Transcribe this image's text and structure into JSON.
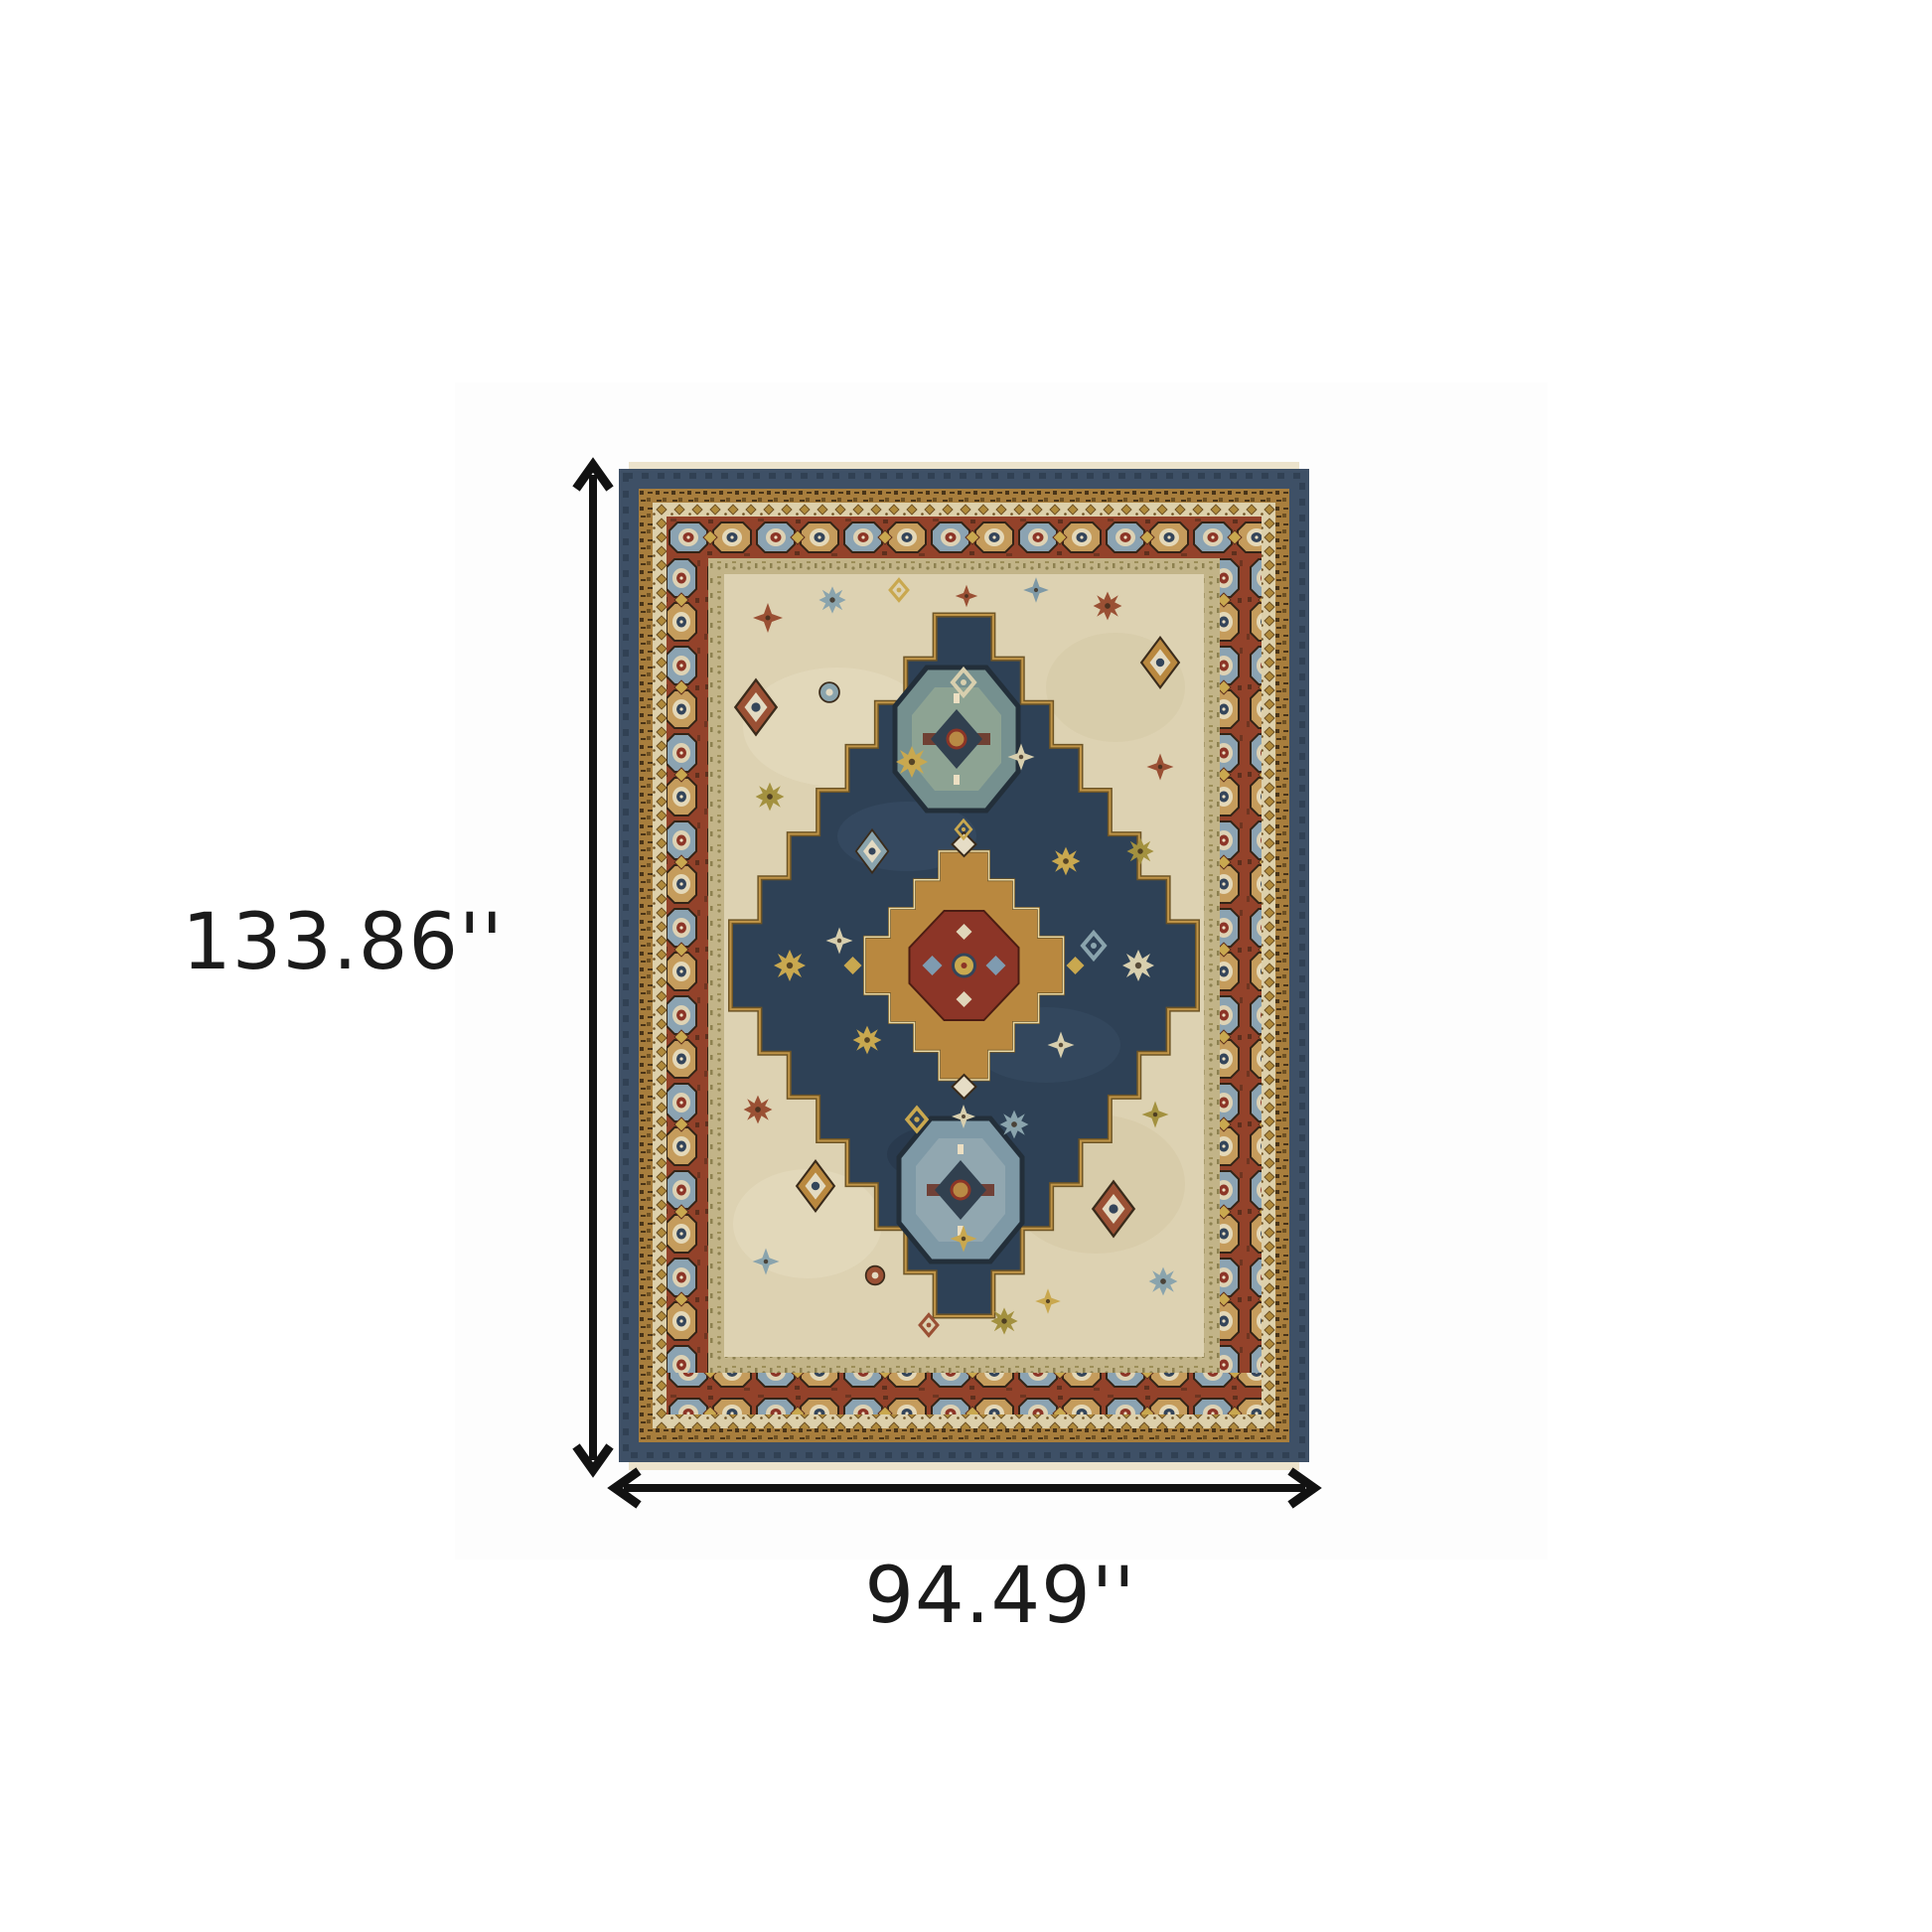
{
  "dimensions": {
    "height_label": "133.86''",
    "width_label": "94.49''"
  },
  "annotation": {
    "arrow_color": "#121212",
    "label_color": "#1b1b1b"
  },
  "rug_colors": {
    "navy_band": "#3e5066",
    "field_navy": "#2e4156",
    "field_cream": "#ddd2b2",
    "rust": "#93422a",
    "gold_band": "#a87e3d",
    "gold": "#b9883f",
    "sage_band": "#c2b488",
    "cream": "#ddd0ab",
    "slate": "#7e99a6",
    "dark_outline": "#3a2b1b"
  }
}
